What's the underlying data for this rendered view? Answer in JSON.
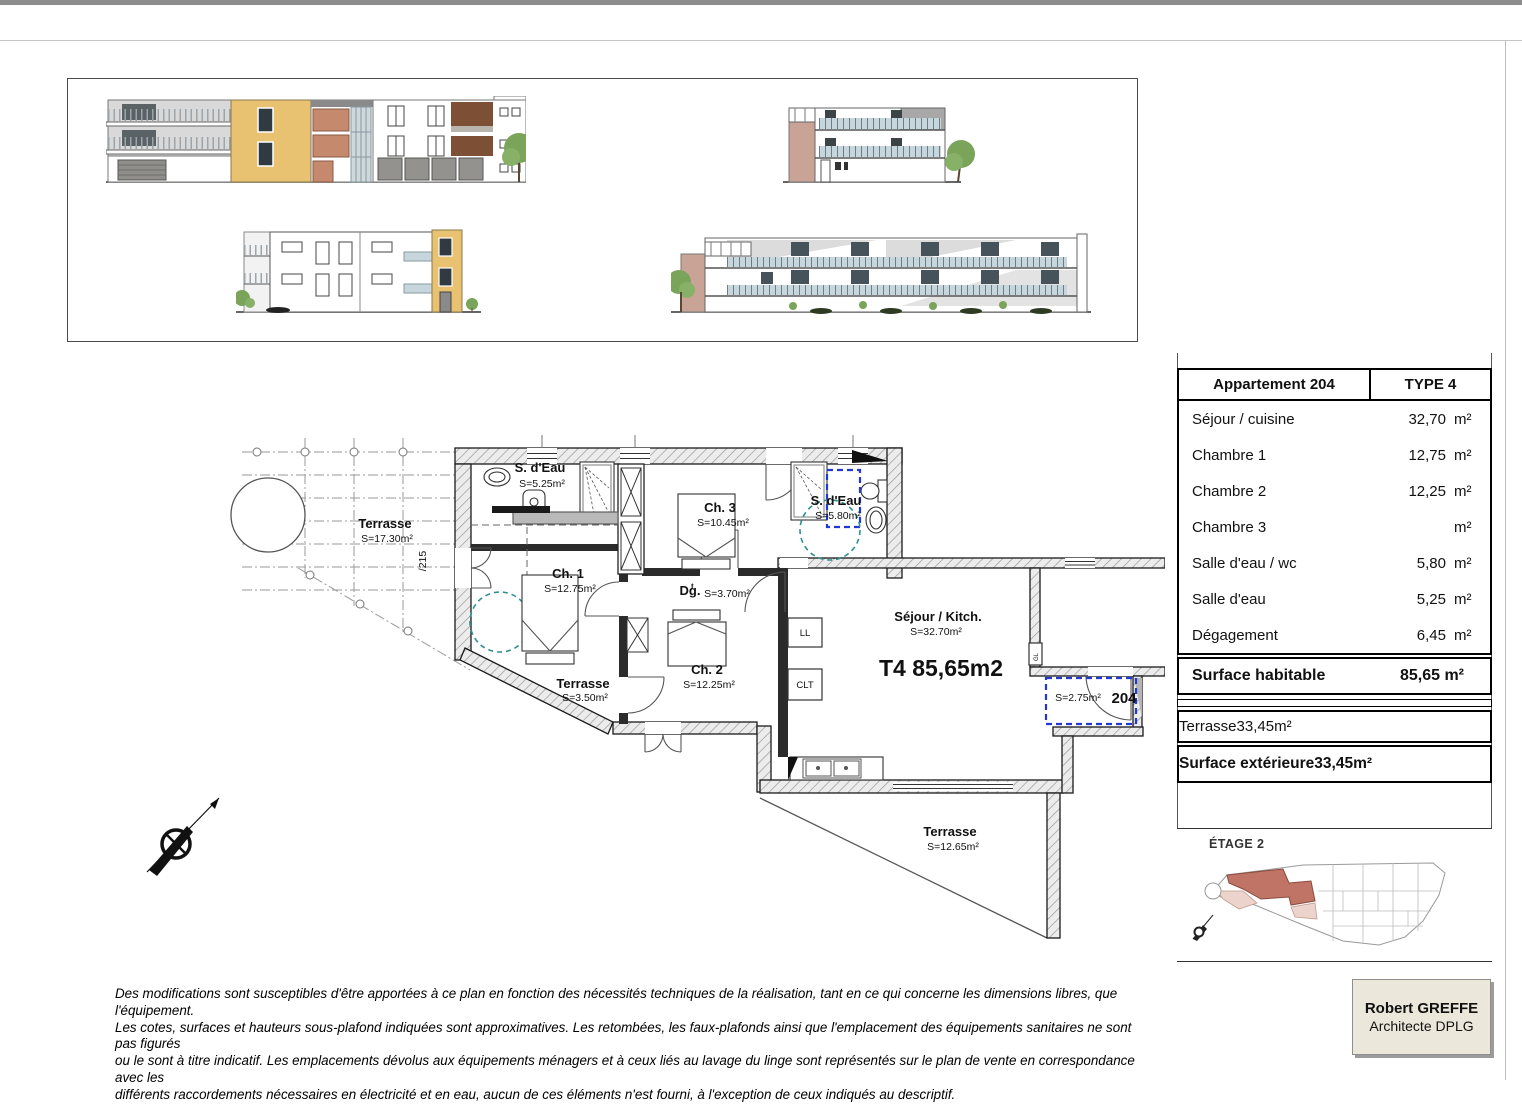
{
  "areas_table": {
    "title_left": "Appartement 204",
    "title_right": "TYPE 4",
    "rows": [
      {
        "label": "Séjour / cuisine",
        "value": "32,70",
        "unit": "m²"
      },
      {
        "label": "Chambre 1",
        "value": "12,75",
        "unit": "m²"
      },
      {
        "label": "Chambre 2",
        "value": "12,25",
        "unit": "m²"
      },
      {
        "label": "Chambre 3",
        "value": "10,45",
        "unit": "m²"
      },
      {
        "label": "Salle d'eau / wc",
        "value": "5,80",
        "unit": "m²"
      },
      {
        "label": "Salle d'eau",
        "value": "5,25",
        "unit": "m²"
      },
      {
        "label": "Dégagement",
        "value": "6,45",
        "unit": "m²"
      }
    ],
    "habitable": {
      "label": "Surface habitable",
      "value": "85,65 m²"
    },
    "terrace_row": {
      "label": "Terrasse",
      "value": "33,45",
      "unit": "m²"
    },
    "exterior_row": {
      "label": "Surface extérieure",
      "value": "33,45",
      "unit": "m²"
    }
  },
  "key_plan": {
    "floor_label": "ÉTAGE 2"
  },
  "plan": {
    "apartment_label": "T4 85,65m2",
    "entry": {
      "number": "204",
      "area": "S=2.75m²"
    },
    "dim_215": "/215",
    "closets": {
      "ll": "LL",
      "clt": "CLT",
      "gl": "GL"
    },
    "rooms": {
      "terrasse1": {
        "name": "Terrasse",
        "area": "S=17.30m²"
      },
      "terrasse2": {
        "name": "Terrasse",
        "area": "S=3.50m²"
      },
      "terrasse3": {
        "name": "Terrasse",
        "area": "S=12.65m²"
      },
      "sdeau1": {
        "name": "S. d'Eau",
        "area": "S=5.25m²"
      },
      "sdeau2": {
        "name": "S. d'Eau",
        "area": "S=5.80m²"
      },
      "ch1": {
        "name": "Ch. 1",
        "area": "S=12.75m²"
      },
      "ch2": {
        "name": "Ch. 2",
        "area": "S=12.25m²"
      },
      "ch3": {
        "name": "Ch. 3",
        "area": "S=10.45m²"
      },
      "dg": {
        "name": "Dg.",
        "sup": "t",
        "area": "S=3.70m²"
      },
      "sejour": {
        "name": "Séjour / Kitch.",
        "area": "S=32.70m²"
      }
    }
  },
  "footer": {
    "disclaimer": [
      "Des modifications sont susceptibles d'être apportées à ce plan en fonction des nécessités techniques de la réalisation, tant en ce qui concerne les dimensions libres, que l'équipement.",
      "Les cotes, surfaces et hauteurs sous-plafond indiquées sont approximatives. Les retombées, les faux-plafonds ainsi que l'emplacement des équipements sanitaires ne sont pas figurés",
      "ou le sont à titre indicatif. Les emplacements dévolus aux équipements ménagers et à ceux liés au lavage du linge sont représentés sur le plan de vente en correspondance avec les",
      "différents raccordements nécessaires en électricité et en eau, aucun de ces éléments n'est fourni, à l'exception de ceux indiqués au descriptif."
    ],
    "architect": {
      "name": "Robert GREFFE",
      "title": "Architecte DPLG"
    }
  },
  "colors": {
    "accent_yellow": "#e9c271",
    "accent_salmon": "#c58a6d",
    "key_highlight": "#bf7465",
    "blue_dashed": "#2238d4",
    "teal_dashed": "#2e8f8f"
  }
}
